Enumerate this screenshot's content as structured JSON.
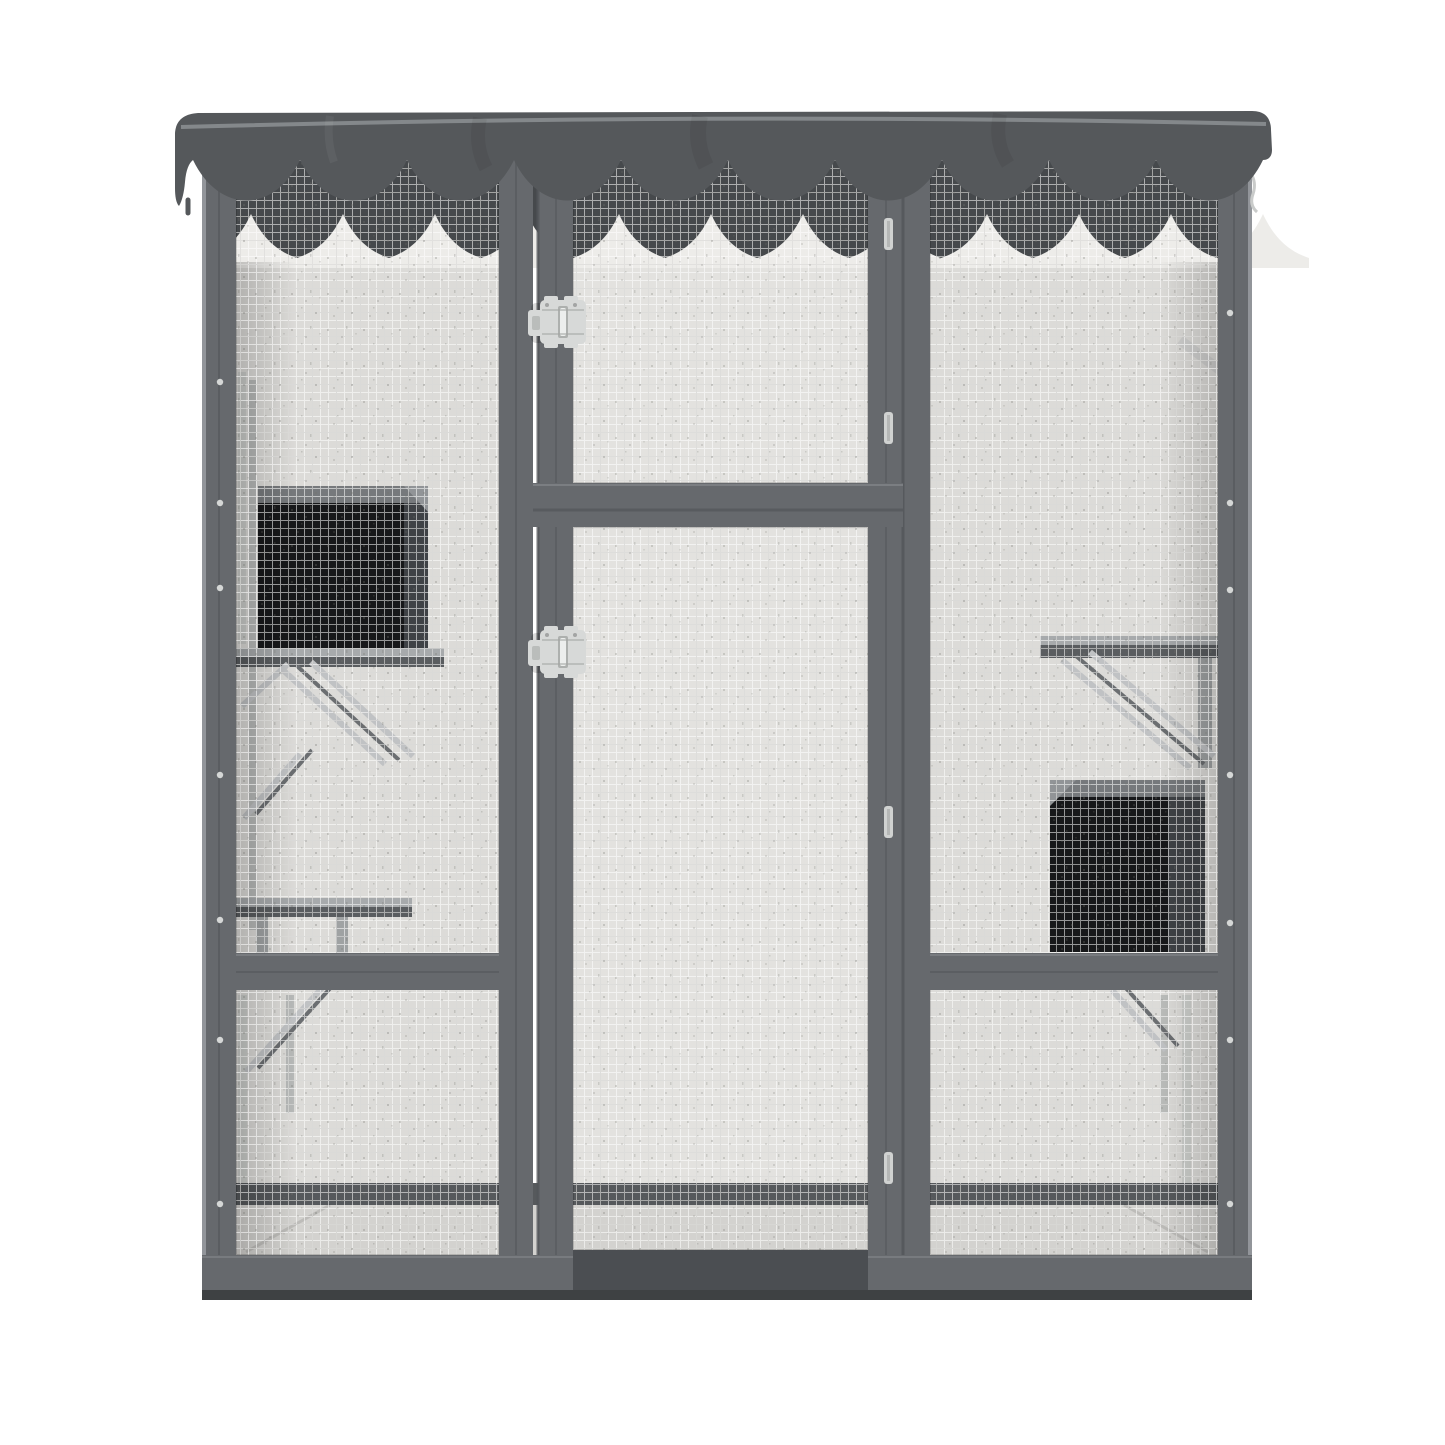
{
  "image": {
    "kind": "product-photo",
    "subject": "outdoor-catio-cat-enclosure",
    "view": "front",
    "visible_text": ""
  },
  "icons": {
    "latch": "slide-bolt-latch",
    "hinge": "door-hinge",
    "screw": "screw-dot",
    "hook": "corner-hook"
  },
  "colors": {
    "background": "#ffffff",
    "roof": "#55585b",
    "roof_highlight": "#8d9094",
    "frame": "#66696d",
    "frame_seam": "#53565a",
    "frame_light": "#92959a",
    "frame_dark": "#4b4e52",
    "base_lip": "#3e4143",
    "mesh_bg": "#dcdbd8",
    "mesh_bg_bright": "#e3e2df",
    "mesh_line": "#ffffff",
    "mesh_line_dark": "#5a5a56",
    "speckle": "#72726c",
    "top_shadow": "#46494c",
    "scallop_back": "#edece9",
    "box_front": "#17181a",
    "box_side": "#3f4246",
    "box_top": "#76797c",
    "box_top_light": "#919497",
    "shelf_top": "#a7aaac",
    "shelf_edge": "#5a5d60",
    "ramp": "#c0c2c4",
    "ramp_dark": "#6b6e71",
    "bar_light": "#c7c9c7",
    "bar_mid": "#9fa2a3",
    "floor": "#d3d2cf",
    "floor_band": "#56595c",
    "latch_body": "#d7d9d8",
    "latch_detail": "#a3a5a4",
    "hinge": "#d0d2d1",
    "screw": "#d5d7d6"
  }
}
